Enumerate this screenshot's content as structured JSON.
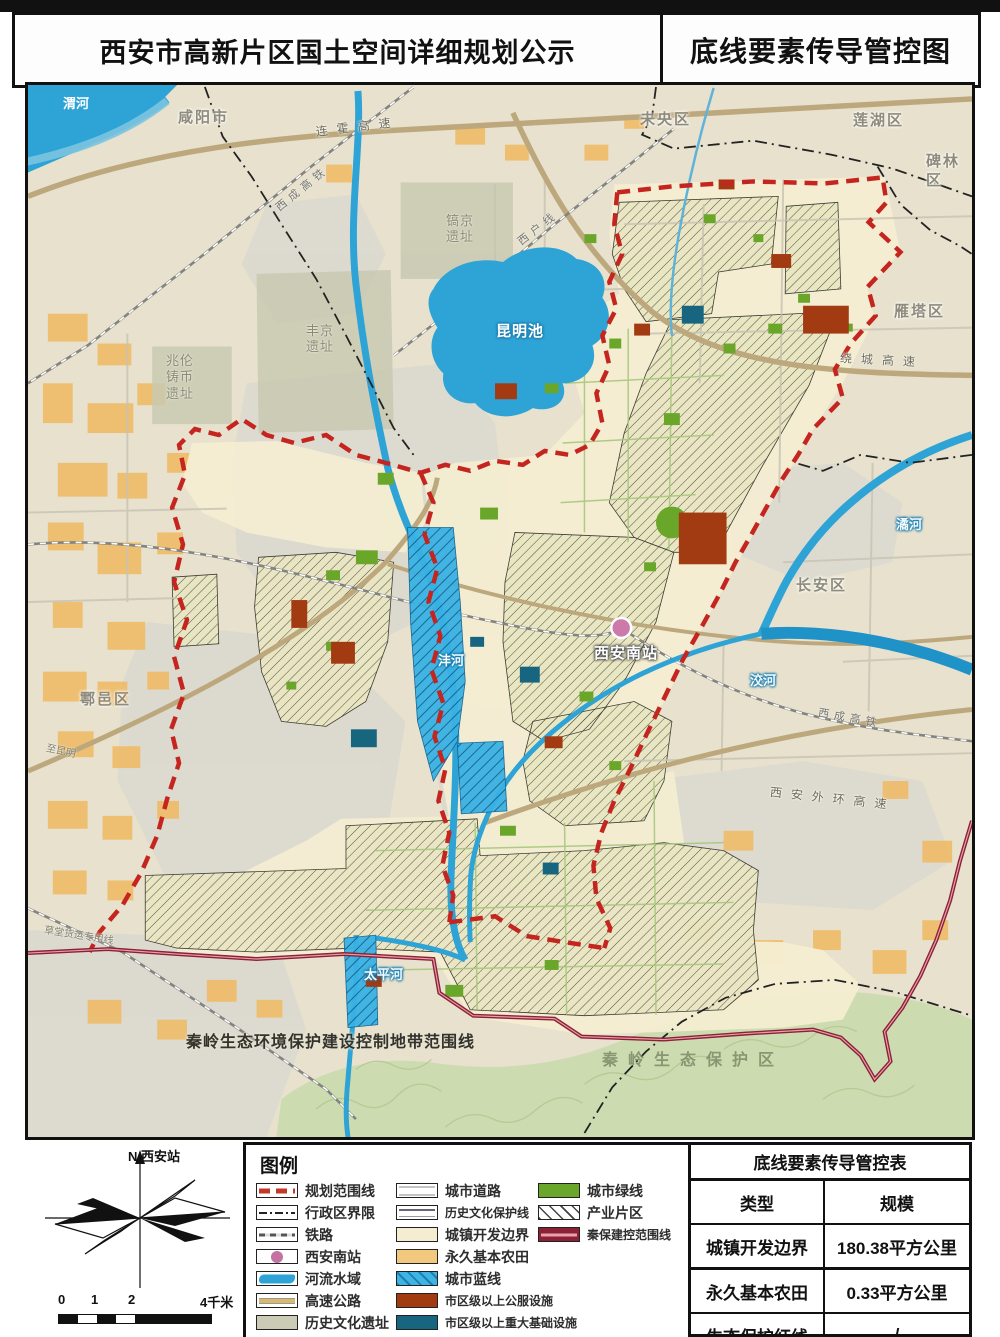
{
  "header": {
    "left_title": "西安市高新片区国土空间详细规划公示",
    "right_title": "底线要素传导管控图"
  },
  "colors": {
    "planning_boundary_red": "#c5251f",
    "qinbao_line": "#8c2135",
    "water_blue": "#2ea3d6",
    "city_green_line": "#6aa62a",
    "farmland_orange": "#f2c87e",
    "public_facility": "#a23a12",
    "infrastructure_teal": "#17657f",
    "dev_boundary_cream": "#f4edd2",
    "station_pink": "#c571a2"
  },
  "map": {
    "labels": [
      {
        "t": "渭河",
        "x": 30,
        "y": 10,
        "c": "water-badge",
        "r": 0
      },
      {
        "t": "咸阳市",
        "x": 150,
        "y": 24,
        "c": "city",
        "r": 0
      },
      {
        "t": "连霍高速",
        "x": 288,
        "y": 40,
        "c": "road",
        "r": -7
      },
      {
        "t": "未央区",
        "x": 612,
        "y": 26,
        "c": "city",
        "r": 0
      },
      {
        "t": "莲湖区",
        "x": 825,
        "y": 27,
        "c": "city",
        "r": 0
      },
      {
        "t": "碑林区",
        "x": 898,
        "y": 68,
        "c": "city",
        "r": 0
      },
      {
        "t": "西成高铁",
        "x": 250,
        "y": 118,
        "c": "rail",
        "r": -39
      },
      {
        "t": "西户线",
        "x": 492,
        "y": 152,
        "c": "rail",
        "r": -38
      },
      {
        "t": "镐京\n遗址",
        "x": 418,
        "y": 128,
        "c": "historic",
        "r": 0
      },
      {
        "t": "丰京\n遗址",
        "x": 278,
        "y": 238,
        "c": "historic",
        "r": 0
      },
      {
        "t": "兆伦\n铸币\n遗址",
        "x": 138,
        "y": 268,
        "c": "historic",
        "r": 0
      },
      {
        "t": "昆明池",
        "x": 468,
        "y": 238,
        "c": "water-big",
        "r": 0
      },
      {
        "t": "绕城高速",
        "x": 812,
        "y": 266,
        "c": "road",
        "r": 3
      },
      {
        "t": "雁塔区",
        "x": 866,
        "y": 218,
        "c": "city",
        "r": 0
      },
      {
        "t": "长安区",
        "x": 768,
        "y": 492,
        "c": "city",
        "r": 0
      },
      {
        "t": "潏河",
        "x": 868,
        "y": 432,
        "c": "water",
        "r": 0
      },
      {
        "t": "西安南站",
        "x": 566,
        "y": 560,
        "c": "station",
        "r": 0
      },
      {
        "t": "沣河",
        "x": 410,
        "y": 568,
        "c": "water",
        "r": 0
      },
      {
        "t": "洨河",
        "x": 722,
        "y": 588,
        "c": "water",
        "r": 0
      },
      {
        "t": "西成高铁",
        "x": 790,
        "y": 622,
        "c": "rail",
        "r": 10
      },
      {
        "t": "西安外环高速",
        "x": 742,
        "y": 700,
        "c": "road",
        "r": 6
      },
      {
        "t": "鄠邑区",
        "x": 52,
        "y": 606,
        "c": "city",
        "r": 0
      },
      {
        "t": "至昆明",
        "x": 18,
        "y": 658,
        "c": "small",
        "r": 12
      },
      {
        "t": "草堂货运专用线",
        "x": 16,
        "y": 840,
        "c": "small",
        "r": 9
      },
      {
        "t": "太平河",
        "x": 336,
        "y": 882,
        "c": "water",
        "r": 0
      },
      {
        "t": "秦岭生态环境保护建设控制地带范围线",
        "x": 158,
        "y": 948,
        "c": "qinling-line",
        "r": 0
      },
      {
        "t": "秦岭生态保护区",
        "x": 574,
        "y": 966,
        "c": "mountain",
        "r": 0
      }
    ],
    "station": {
      "label": "西安南站"
    }
  },
  "legend": {
    "title": "图例",
    "columns": [
      [
        {
          "label": "规划范围线",
          "type": "planning-line"
        },
        {
          "label": "行政区界限",
          "type": "admin-line"
        },
        {
          "label": "铁路",
          "type": "railway"
        },
        {
          "label": "西安南站",
          "type": "station"
        },
        {
          "label": "河流水域",
          "type": "water"
        },
        {
          "label": "高速公路",
          "type": "highway"
        },
        {
          "label": "历史文化遗址",
          "type": "historic"
        }
      ],
      [
        {
          "label": "城市道路",
          "type": "road"
        },
        {
          "label": "历史文化保护线",
          "type": "heritage-line"
        },
        {
          "label": "城镇开发边界",
          "type": "dev"
        },
        {
          "label": "永久基本农田",
          "type": "farm"
        },
        {
          "label": "城市蓝线",
          "type": "blue"
        },
        {
          "label": "市区级以上公服设施",
          "type": "public"
        },
        {
          "label": "市区级以上重大基础设施",
          "type": "infra"
        }
      ],
      [
        {
          "label": "城市绿线",
          "type": "green"
        },
        {
          "label": "产业片区",
          "type": "industry"
        },
        {
          "label": "秦保建控范围线",
          "type": "qinbao"
        }
      ]
    ]
  },
  "compass": {
    "label": "N 西安站"
  },
  "scalebar": {
    "labels": [
      {
        "t": "0",
        "x": 0
      },
      {
        "t": "1",
        "x": 33
      },
      {
        "t": "2",
        "x": 70
      },
      {
        "t": "4千米",
        "x": 142
      }
    ]
  },
  "table": {
    "title": "底线要素传导管控表",
    "col_headers": [
      "类型",
      "规模"
    ],
    "rows": [
      [
        "城镇开发边界",
        "180.38平方公里"
      ],
      [
        "永久基本农田",
        "0.33平方公里"
      ],
      [
        "生态保护红线",
        "/"
      ]
    ]
  }
}
